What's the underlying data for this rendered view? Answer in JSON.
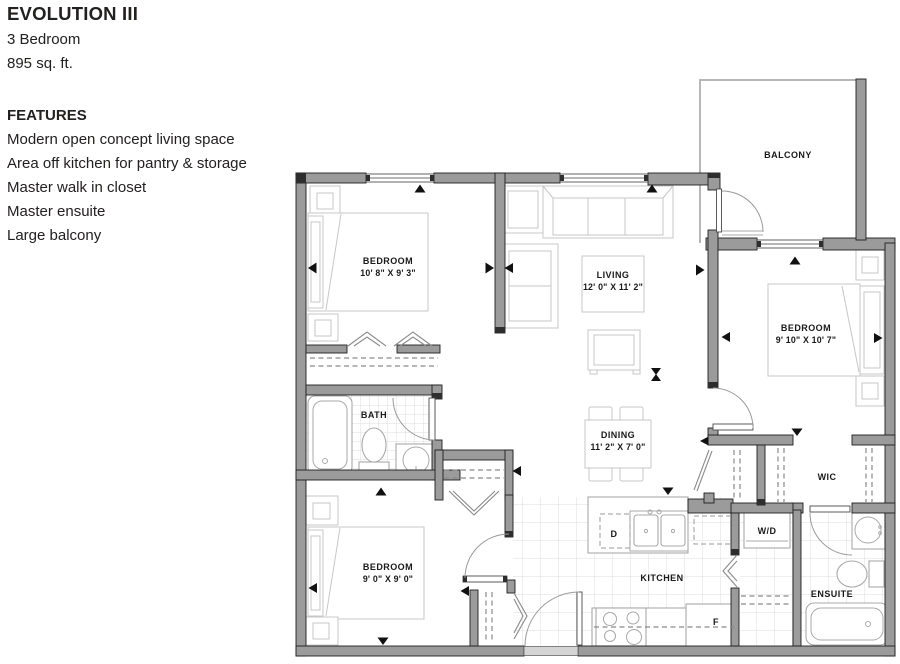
{
  "panel": {
    "title": "EVOLUTION III",
    "subtitle_lines": [
      "3 Bedroom",
      "895 sq. ft."
    ],
    "features_heading": "FEATURES",
    "features": [
      "Modern open concept living space",
      "Area off kitchen for pantry & storage",
      "Master walk in closet",
      "Master ensuite",
      "Large balcony"
    ]
  },
  "floorplan": {
    "rooms": {
      "balcony": {
        "name": "BALCONY"
      },
      "bedroom1": {
        "name": "BEDROOM",
        "dims": "10' 8\" X 9' 3\""
      },
      "living": {
        "name": "LIVING",
        "dims": "12' 0\" X 11' 2\""
      },
      "master": {
        "name": "BEDROOM",
        "dims": "9' 10\" X 10' 7\""
      },
      "bath": {
        "name": "BATH"
      },
      "dining": {
        "name": "DINING",
        "dims": "11' 2\" X 7' 0\""
      },
      "wic": {
        "name": "WIC"
      },
      "bedroom3": {
        "name": "BEDROOM",
        "dims": "9' 0\" X 9' 0\""
      },
      "kitchen": {
        "name": "KITCHEN"
      },
      "laundry": {
        "name": "W/D"
      },
      "ensuite": {
        "name": "ENSUITE"
      }
    },
    "appliances": {
      "dishwasher": "D",
      "fridge": "F"
    },
    "theme": {
      "wall": "#9b9b9b",
      "wall_edge": "#1f1f1f",
      "furniture_line": "#c7c7c7",
      "fixture_line": "#a9a9a9",
      "tile_line": "#dedede",
      "label": "#191919",
      "text": "#232020"
    }
  }
}
